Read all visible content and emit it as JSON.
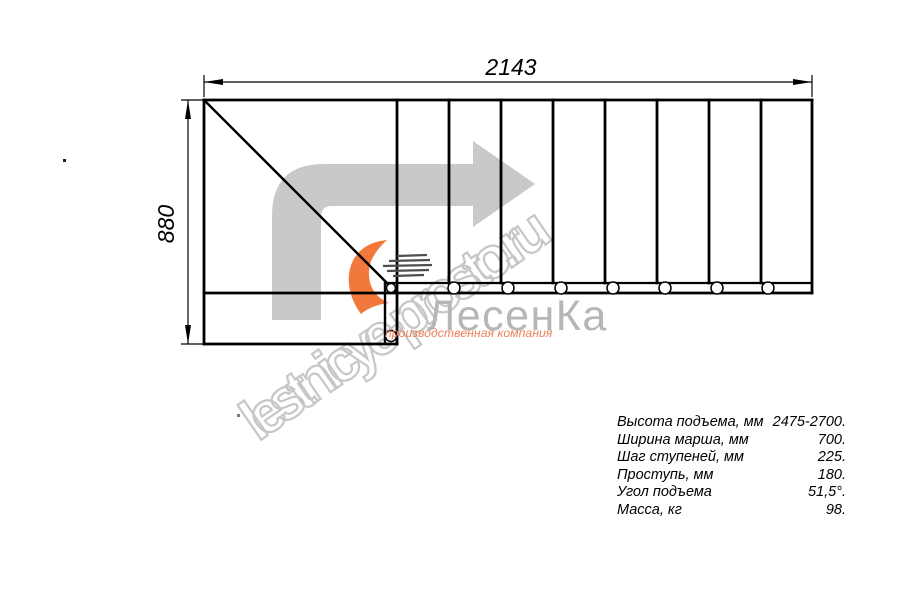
{
  "drawing": {
    "title": "staircase plan view",
    "total_length_label": "2143",
    "total_width_label": "880",
    "step_divider_count": 8,
    "mount_hole_count": 9,
    "line_color": "#000000",
    "direction_arrow_color": "#c9c9c9"
  },
  "watermark": {
    "text": "lestnicye-prosto.ru",
    "color": "#c7c7c7"
  },
  "logo": {
    "name": "ЛесенКа",
    "subtitle": "производственная компания",
    "name_color": "#b6b6b6",
    "accent_color": "#f2793c",
    "subtitle_color": "#ee7f58"
  },
  "specs": {
    "rows": [
      {
        "label": "Высота подъема, мм",
        "value": "2475-2700."
      },
      {
        "label": "Ширина марша, мм",
        "value": "700."
      },
      {
        "label": "Шаг ступеней, мм",
        "value": "225."
      },
      {
        "label": "Проступь, мм",
        "value": "180."
      },
      {
        "label": "Угол подъема",
        "value": "51,5°."
      },
      {
        "label": "Масса, кг",
        "value": "98."
      }
    ]
  }
}
